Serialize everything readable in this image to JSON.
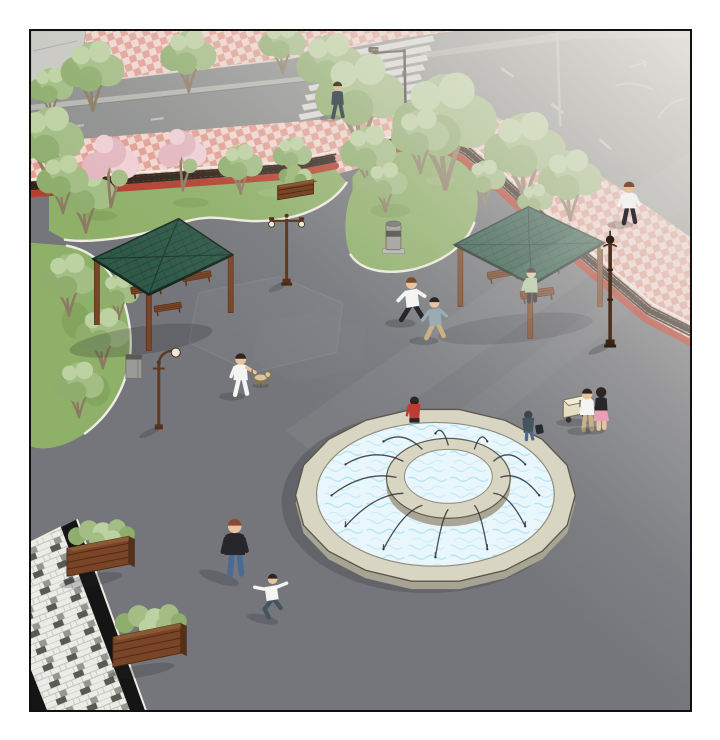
{
  "scene": {
    "title": "Aerial plaza illustration with circular fountain",
    "description": "Aerial comic-style illustration of a public plaza: a two-tier circular fountain with arcing water jets, two green-roofed wooden pavilions with benches, lawns with leafy and pink blossom trees, a low red wall topped by a dark ornamental fence separating pink checkerboard sidewalks, a street with a zebra crosswalk and traffic light fading into fog at the upper right, wooden planter boxes, ornate lamp posts, litter bins, a black-bordered mosaic walkway across the bottom-left corner, and scattered pedestrians.",
    "palette": {
      "plaza": "#74767b",
      "plaza_light": "#83858a",
      "road": "#8e908f",
      "road_line": "#e2e2de",
      "road_median": "#bdbdb6",
      "concrete": "#c8c8c4",
      "sidewalk_pink": "#e2a093",
      "sidewalk_pale": "#f1d7d0",
      "wall_red": "#b3402f",
      "fence_dark": "#2e2118",
      "curb_white": "#efece2",
      "lawn": "#8fb069",
      "lawn_dark": "#789a54",
      "lawn_light": "#a8c184",
      "tree_green": "#a3bd85",
      "tree_green_dark": "#8fae6e",
      "tree_green_light": "#bdd2a2",
      "blossom": "#e3b7c1",
      "blossom_light": "#efd0d6",
      "trunk": "#8c7b63",
      "roof_green": "#2f5a49",
      "roof_line": "#1e352c",
      "wood": "#7a4526",
      "wood_dark": "#58301a",
      "wood_light": "#8a5a34",
      "stone": "#d9d5c3",
      "stone_dark": "#a8a494",
      "stone_edge": "#6e6a5c",
      "water": "#e9f7fd",
      "water_line": "#9ddcf1",
      "jet": "#2f3034",
      "mosaic_light": "#ebebe7",
      "mosaic_line": "#c2c2bd",
      "mosaic_dark": "#4a4a44",
      "mosaic_mid": "#8e8e88",
      "band_black": "#151515",
      "fog": "#eae6e0",
      "shadow": "#24242a",
      "skin": "#e9c49e",
      "white": "#f4f4f2",
      "black": "#26262b",
      "navy": "#3c4357",
      "red": "#bf3a33",
      "teal": "#45555e",
      "jeans": "#4b6a92",
      "khaki": "#c9b184",
      "pink": "#e8a0b4",
      "grayblue": "#9aabb4",
      "green_shirt": "#b5c9a3",
      "hair_dark": "#2e2420",
      "hair_brown": "#7a4a2e",
      "dog_tan": "#d9c59c",
      "cart": "#e6dec2",
      "bin": "#9a9a96",
      "bin_dark": "#3e3e3a",
      "metal": "#b4b4b0",
      "signal_dark": "#38342e"
    },
    "landmarks": [
      {
        "label": "street",
        "note": "asphalt road with zebra crosswalk, traffic light, median strip and lane markings, fog toward the upper right"
      },
      {
        "label": "sidewalks",
        "note": "pink checkerboard paving along both sides of the street"
      },
      {
        "label": "boundary",
        "note": "low red wall topped by a dark ornamental fence with a white curb"
      },
      {
        "label": "left-pavilion",
        "note": "square pavilion, green tiled hip roof on wooden posts, benches beneath"
      },
      {
        "label": "right-pavilion",
        "note": "square pavilion, green tiled hip roof, one person seated on a bench"
      },
      {
        "label": "fountain",
        "note": "round two-tier fountain, raised center ring, twelve arcing water jets, two people seated on the rim"
      },
      {
        "label": "lawns",
        "note": "three lawn beds edged with white curbs, leafy green and pink blossom trees"
      },
      {
        "label": "planters",
        "note": "three wooden planter boxes with shrubs"
      },
      {
        "label": "street-furniture",
        "note": "ornate lamp posts, two litter bins, street light pole"
      },
      {
        "label": "mosaic-walkway",
        "note": "black-bordered gray mosaic path crossing the bottom-left corner"
      }
    ],
    "pedestrians": [
      {
        "id": "crosswalk-walker",
        "clothing": "dark navy outfit"
      },
      {
        "id": "sidewalk-walker",
        "clothing": "white shirt, dark trousers"
      },
      {
        "id": "dog-walker",
        "clothing": "white shirt and trousers",
        "companion": "tan dog"
      },
      {
        "id": "runner-1",
        "clothing": "white shirt, black trousers"
      },
      {
        "id": "runner-2",
        "clothing": "gray-blue shirt, khaki trousers"
      },
      {
        "id": "bench-sitter",
        "clothing": "light green shirt"
      },
      {
        "id": "fountain-sitter-red",
        "clothing": "red shirt, dark trousers"
      },
      {
        "id": "fountain-sitter-hooded",
        "clothing": "dark hooded jacket, blue jeans, dark bag"
      },
      {
        "id": "cart-man",
        "clothing": "white shirt, khaki trousers",
        "companion": "beige hand cart"
      },
      {
        "id": "cart-woman",
        "clothing": "black top, pink skirt"
      },
      {
        "id": "black-jacket-walker",
        "clothing": "black jacket, blue jeans"
      },
      {
        "id": "skater",
        "clothing": "white shirt, dark teal trousers, arms out"
      }
    ]
  }
}
